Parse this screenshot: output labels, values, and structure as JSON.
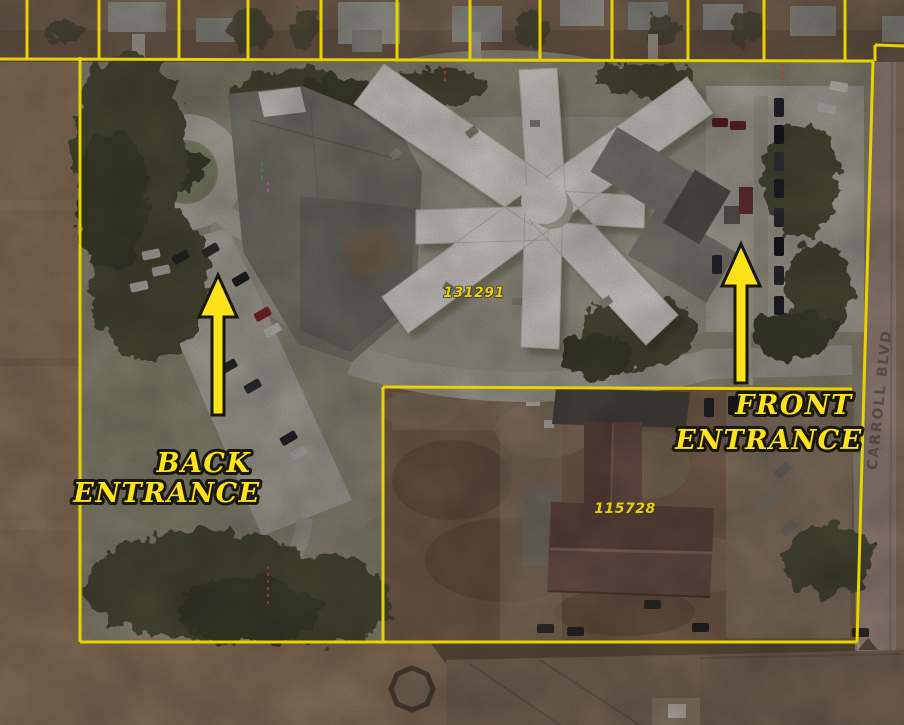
{
  "map": {
    "annotations": {
      "back_entrance": {
        "line1": "BACK",
        "line2": "ENTRANCE"
      },
      "front_entrance": {
        "line1": "FRONT",
        "line2": "ENTRANCE"
      },
      "street": "CARROLL BLVD",
      "parcel_main": "131291",
      "parcel_secondary": "115728"
    },
    "colors": {
      "annotation_yellow": "#ffe21a",
      "annotation_outline": "#17170a",
      "boundary_yellow": "#e9d200",
      "parcel_label": "#e8cf10",
      "street_label": "#4e4342"
    }
  }
}
